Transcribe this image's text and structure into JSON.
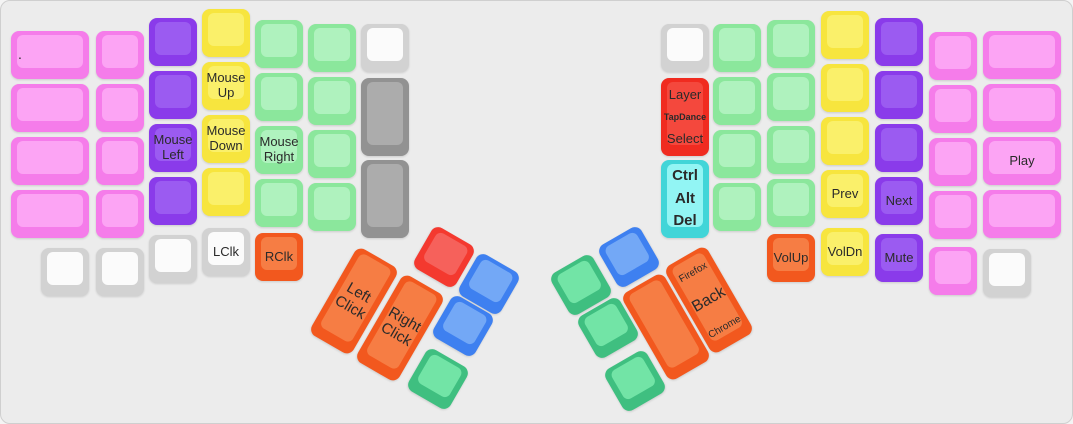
{
  "keyboard": {
    "background": "#ececec",
    "label_color": "#2a2a2a",
    "default_key_size": 48,
    "palette": {
      "pink": {
        "base": "#f57cea",
        "top": "#fca4f4"
      },
      "purple": {
        "base": "#8a3bea",
        "top": "#9b5bf1"
      },
      "yellow": {
        "base": "#f7e53e",
        "top": "#faf06a"
      },
      "mint": {
        "base": "#8be79c",
        "top": "#aff2be"
      },
      "white": {
        "base": "#d2d2d2",
        "top": "#fbfbfb"
      },
      "gray": {
        "base": "#929292",
        "top": "#acacac"
      },
      "red": {
        "base": "#f02b20",
        "top": "#f4483d"
      },
      "red2": {
        "base": "#f4392f",
        "top": "#f6615b"
      },
      "cyan": {
        "base": "#41d5d8",
        "top": "#92f5f4"
      },
      "orange": {
        "base": "#f2581e",
        "top": "#f67d44"
      },
      "blue": {
        "base": "#3e80f0",
        "top": "#73a8f6"
      },
      "green2": {
        "base": "#3fbf80",
        "top": "#72e4a6"
      }
    },
    "groups": [
      {
        "name": "left-half",
        "rot": 0,
        "keys": [
          {
            "x": 10,
            "y": 30,
            "w": 78,
            "c": "pink",
            "n": "key-dot",
            "la": 1,
            "lines": [
              {
                "t": ".",
                "s": 14
              }
            ]
          },
          {
            "x": 10,
            "y": 83,
            "w": 78,
            "c": "pink"
          },
          {
            "x": 10,
            "y": 136,
            "w": 78,
            "c": "pink"
          },
          {
            "x": 10,
            "y": 189,
            "w": 78,
            "c": "pink"
          },
          {
            "x": 40,
            "y": 247,
            "c": "white"
          },
          {
            "x": 95,
            "y": 30,
            "c": "pink"
          },
          {
            "x": 95,
            "y": 83,
            "c": "pink"
          },
          {
            "x": 95,
            "y": 136,
            "c": "pink"
          },
          {
            "x": 95,
            "y": 189,
            "c": "pink"
          },
          {
            "x": 95,
            "y": 247,
            "c": "white"
          },
          {
            "x": 148,
            "y": 17,
            "c": "purple"
          },
          {
            "x": 148,
            "y": 70,
            "c": "purple"
          },
          {
            "x": 148,
            "y": 123,
            "c": "purple",
            "n": "key-mouse-left",
            "lines": [
              {
                "t": "Mouse"
              },
              {
                "t": "Left"
              }
            ]
          },
          {
            "x": 148,
            "y": 176,
            "c": "purple"
          },
          {
            "x": 148,
            "y": 234,
            "c": "white"
          },
          {
            "x": 201,
            "y": 8,
            "c": "yellow"
          },
          {
            "x": 201,
            "y": 61,
            "c": "yellow",
            "n": "key-mouse-up",
            "lines": [
              {
                "t": "Mouse"
              },
              {
                "t": "Up"
              }
            ]
          },
          {
            "x": 201,
            "y": 114,
            "c": "yellow",
            "n": "key-mouse-down",
            "lines": [
              {
                "t": "Mouse"
              },
              {
                "t": "Down"
              }
            ]
          },
          {
            "x": 201,
            "y": 167,
            "c": "yellow"
          },
          {
            "x": 201,
            "y": 227,
            "c": "white",
            "n": "key-lclk",
            "lines": [
              {
                "t": "LClk"
              }
            ]
          },
          {
            "x": 254,
            "y": 19,
            "c": "mint"
          },
          {
            "x": 254,
            "y": 72,
            "c": "mint"
          },
          {
            "x": 254,
            "y": 125,
            "c": "mint",
            "n": "key-mouse-right",
            "lines": [
              {
                "t": "Mouse"
              },
              {
                "t": "Right"
              }
            ]
          },
          {
            "x": 254,
            "y": 178,
            "c": "mint"
          },
          {
            "x": 254,
            "y": 232,
            "c": "orange",
            "n": "key-rclk",
            "lines": [
              {
                "t": "RClk"
              }
            ]
          },
          {
            "x": 307,
            "y": 23,
            "c": "mint"
          },
          {
            "x": 307,
            "y": 76,
            "c": "mint"
          },
          {
            "x": 307,
            "y": 129,
            "c": "mint"
          },
          {
            "x": 307,
            "y": 182,
            "c": "mint"
          },
          {
            "x": 360,
            "y": 23,
            "c": "white"
          },
          {
            "x": 360,
            "y": 77,
            "h": 78,
            "c": "gray"
          },
          {
            "x": 360,
            "y": 159,
            "h": 78,
            "c": "gray"
          }
        ]
      },
      {
        "name": "left-thumb-cluster",
        "rot": 30,
        "keys": [
          {
            "x": 419,
            "y": 232,
            "c": "red2",
            "n": "key-thumb-red"
          },
          {
            "x": 464,
            "y": 259,
            "c": "blue",
            "n": "key-thumb-blue-1"
          },
          {
            "x": 438,
            "y": 301,
            "c": "blue",
            "n": "key-thumb-blue-2"
          },
          {
            "x": 413,
            "y": 354,
            "c": "green2",
            "n": "key-thumb-green"
          },
          {
            "x": 329,
            "y": 250,
            "h": 100,
            "c": "orange",
            "n": "key-left-click",
            "s": 15,
            "lines": [
              {
                "t": "Left"
              },
              {
                "t": "Click"
              }
            ]
          },
          {
            "x": 375,
            "y": 277,
            "h": 100,
            "c": "orange",
            "n": "key-right-click",
            "s": 15,
            "lines": [
              {
                "t": "Right"
              },
              {
                "t": "Click"
              }
            ]
          }
        ]
      },
      {
        "name": "right-thumb-cluster",
        "rot": -30,
        "keys": [
          {
            "x": 604,
            "y": 232,
            "c": "blue",
            "n": "key-thumb-blue-r"
          },
          {
            "x": 556,
            "y": 260,
            "c": "green2",
            "n": "key-thumb-green-1"
          },
          {
            "x": 583,
            "y": 303,
            "c": "green2",
            "n": "key-thumb-green-2"
          },
          {
            "x": 610,
            "y": 356,
            "c": "green2",
            "n": "key-thumb-green-3"
          },
          {
            "x": 641,
            "y": 276,
            "h": 100,
            "c": "orange",
            "n": "key-thumb-orange-blank"
          },
          {
            "x": 684,
            "y": 249,
            "h": 100,
            "c": "orange",
            "n": "key-back",
            "lay": "spread",
            "lines": [
              {
                "t": "Firefox",
                "s": 10
              },
              {
                "t": "Back",
                "s": 16
              },
              {
                "t": "Chrome",
                "s": 10
              }
            ]
          }
        ]
      },
      {
        "name": "right-half",
        "rot": 0,
        "keys": [
          {
            "x": 660,
            "y": 23,
            "c": "white"
          },
          {
            "x": 660,
            "y": 77,
            "h": 78,
            "c": "red",
            "n": "key-layer-tapdance-select",
            "lay": "spread",
            "lines": [
              {
                "t": "Layer"
              },
              {
                "t": "TapDance",
                "s": 9,
                "b": 1
              },
              {
                "t": "Select"
              }
            ]
          },
          {
            "x": 660,
            "y": 159,
            "h": 78,
            "c": "cyan",
            "n": "key-ctrl-alt-del",
            "lay": "spread",
            "lines": [
              {
                "t": "Ctrl",
                "s": 15,
                "b": 1
              },
              {
                "t": "Alt",
                "s": 15,
                "b": 1
              },
              {
                "t": "Del",
                "s": 15,
                "b": 1
              }
            ]
          },
          {
            "x": 712,
            "y": 23,
            "c": "mint"
          },
          {
            "x": 712,
            "y": 76,
            "c": "mint"
          },
          {
            "x": 712,
            "y": 129,
            "c": "mint"
          },
          {
            "x": 712,
            "y": 182,
            "c": "mint"
          },
          {
            "x": 766,
            "y": 19,
            "c": "mint"
          },
          {
            "x": 766,
            "y": 72,
            "c": "mint"
          },
          {
            "x": 766,
            "y": 125,
            "c": "mint"
          },
          {
            "x": 766,
            "y": 178,
            "c": "mint"
          },
          {
            "x": 766,
            "y": 233,
            "c": "orange",
            "n": "key-volup",
            "lines": [
              {
                "t": "VolUp"
              }
            ]
          },
          {
            "x": 820,
            "y": 10,
            "c": "yellow"
          },
          {
            "x": 820,
            "y": 63,
            "c": "yellow"
          },
          {
            "x": 820,
            "y": 116,
            "c": "yellow"
          },
          {
            "x": 820,
            "y": 169,
            "c": "yellow",
            "n": "key-prev",
            "lines": [
              {
                "t": "Prev"
              }
            ]
          },
          {
            "x": 820,
            "y": 227,
            "c": "yellow",
            "n": "key-voldn",
            "lines": [
              {
                "t": "VolDn"
              }
            ]
          },
          {
            "x": 874,
            "y": 17,
            "c": "purple"
          },
          {
            "x": 874,
            "y": 70,
            "c": "purple"
          },
          {
            "x": 874,
            "y": 123,
            "c": "purple"
          },
          {
            "x": 874,
            "y": 176,
            "c": "purple",
            "n": "key-next",
            "lines": [
              {
                "t": "Next"
              }
            ]
          },
          {
            "x": 874,
            "y": 233,
            "c": "purple",
            "n": "key-mute",
            "lines": [
              {
                "t": "Mute"
              }
            ]
          },
          {
            "x": 928,
            "y": 31,
            "c": "pink"
          },
          {
            "x": 928,
            "y": 84,
            "c": "pink"
          },
          {
            "x": 928,
            "y": 137,
            "c": "pink"
          },
          {
            "x": 928,
            "y": 190,
            "c": "pink"
          },
          {
            "x": 928,
            "y": 246,
            "c": "pink"
          },
          {
            "x": 982,
            "y": 30,
            "w": 78,
            "c": "pink"
          },
          {
            "x": 982,
            "y": 83,
            "w": 78,
            "c": "pink"
          },
          {
            "x": 982,
            "y": 136,
            "w": 78,
            "c": "pink",
            "n": "key-play",
            "lines": [
              {
                "t": "Play"
              }
            ]
          },
          {
            "x": 982,
            "y": 189,
            "w": 78,
            "c": "pink"
          },
          {
            "x": 982,
            "y": 248,
            "c": "white"
          }
        ]
      }
    ]
  }
}
